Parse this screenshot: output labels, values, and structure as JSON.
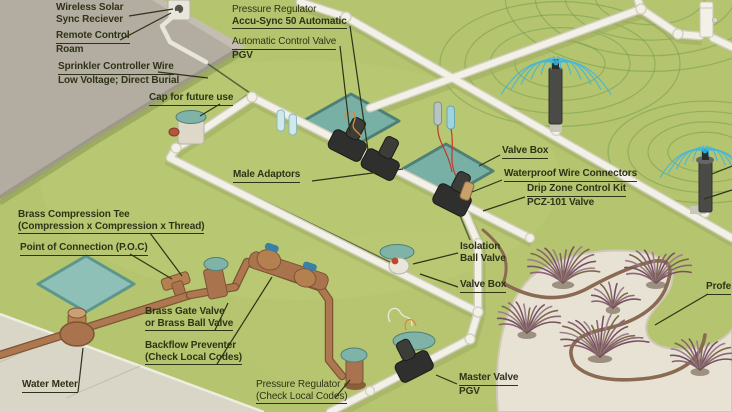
{
  "diagram": {
    "title": "Residential irrigation system installation diagram",
    "labels": {
      "wireless_receiver": {
        "line1": "Wireless Solar",
        "line2": "Sync Reciever"
      },
      "remote_control": {
        "line1": "Remote Control",
        "line2": "Roam"
      },
      "controller_wire": {
        "line1": "Sprinkler Controller Wire",
        "line2": "Low Voltage; Direct Burial"
      },
      "cap_future": {
        "line1": "Cap for future use"
      },
      "pressure_regulator_auto": {
        "line1": "Pressure Regulator",
        "line2": "Accu-Sync 50 Automatic"
      },
      "auto_control_valve": {
        "line1": "Automatic Control Valve",
        "line2": "PGV"
      },
      "male_adaptors": {
        "line1": "Male Adaptors"
      },
      "valve_box_right": {
        "line1": "Valve Box"
      },
      "wire_connectors": {
        "line1": "Waterproof Wire Connectors"
      },
      "drip_zone_kit": {
        "line1": "Drip Zone Control Kit",
        "line2": "PCZ-101 Valve"
      },
      "compression_tee": {
        "line1": "Brass Compression Tee",
        "line2": "(Compression x Compression x Thread)"
      },
      "poc": {
        "line1": "Point of Connection (P.O.C)"
      },
      "isolation_valve": {
        "line1": "Isolation",
        "line2": "Ball Valve"
      },
      "valve_box_mid": {
        "line1": "Valve Box"
      },
      "gate_valve": {
        "line1": "Brass Gate Valve",
        "line2": "or Brass Ball Valve"
      },
      "backflow": {
        "line1": "Backflow Preventer",
        "line2": "(Check Local Codes)"
      },
      "water_meter": {
        "line1": "Water Meter"
      },
      "pressure_regulator_codes": {
        "line1": "Pressure Regulator",
        "line2": "(Check Local Codes)"
      },
      "master_valve": {
        "line1": "Master Valve",
        "line2": "PGV"
      },
      "professional_clipped": {
        "line1": "Profe"
      }
    },
    "colors": {
      "grass": "#b5c46e",
      "pvc_pipe": "#f3f1e7",
      "copper_pipe": "#ad7850",
      "valve_box_lid": "#7fb3a8",
      "spray_water": "#3fb6de",
      "coverage_arc": "#6f9a4e",
      "label_text": "#2e3317",
      "mulch_bed": "#e8e2d4",
      "wall": "#b3aca0",
      "sidewalk": "#d9d5c7",
      "valve_body": "#2f2f2d"
    }
  }
}
